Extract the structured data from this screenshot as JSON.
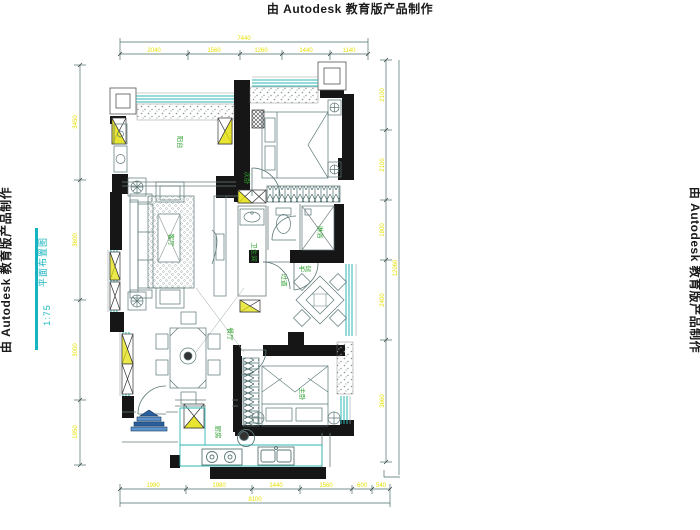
{
  "watermarks": {
    "top": "由 Autodesk 教育版产品制作",
    "left": "由 Autodesk 教育版产品制作",
    "right": "由 Autodesk 教育版产品制作"
  },
  "title": {
    "name": "平面布置图",
    "scale": "1:75"
  },
  "rooms": {
    "balcony": "阳台",
    "bedroom2": "次卧",
    "living": "客厅",
    "hallway": "过道",
    "bathroom": "卫生间",
    "shower": "淋浴",
    "study": "书房",
    "dining": "餐厅",
    "kitchen": "厨房",
    "master": "主卧"
  },
  "dimensions": {
    "top": {
      "overall": "7440",
      "segments": [
        "2040",
        "1560",
        "1260",
        "1440",
        "1140"
      ]
    },
    "bottom": {
      "overall": "8100",
      "segments": [
        "1980",
        "1980",
        "1440",
        "1560",
        "600",
        "540"
      ]
    },
    "left": {
      "segments": [
        "3450",
        "3600",
        "3000",
        "1950"
      ]
    },
    "right": {
      "overall": "12060",
      "segments": [
        "2100",
        "2100",
        "1800",
        "2400",
        "3660"
      ]
    }
  },
  "colors": {
    "wall": "#161616",
    "window": "#2fb5b5",
    "dimension_line": "#4a6b6b",
    "dimension_text": "#e3df00",
    "room_label": "#2ea02e",
    "furniture_line": "#5b7676",
    "title_text": "#16b3c0",
    "entry_symbol_blue": "#2c5f9e"
  }
}
